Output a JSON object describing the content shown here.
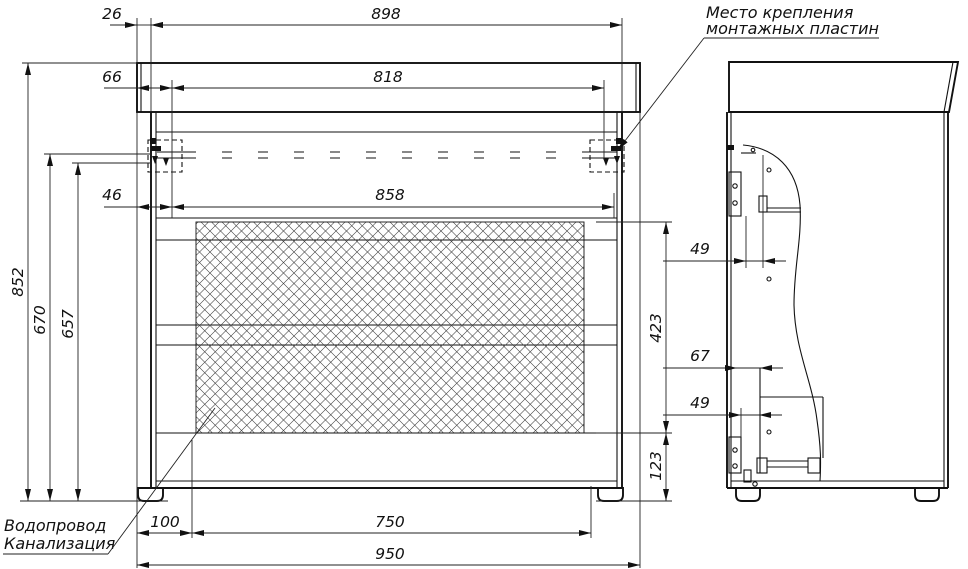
{
  "dims": {
    "d26": "26",
    "d898": "898",
    "d66": "66",
    "d818": "818",
    "d46": "46",
    "d858": "858",
    "d852": "852",
    "d670": "670",
    "d657": "657",
    "d423": "423",
    "d123": "123",
    "d100": "100",
    "d750": "750",
    "d950": "950",
    "d49_top": "49",
    "d67": "67",
    "d49_bottom": "49"
  },
  "annotations": {
    "mounting_line1": "Место крепления",
    "mounting_line2": "монтажных пластин",
    "water": "Водопровод",
    "sewer": "Канализация"
  },
  "colors": {
    "line": "#111111",
    "background": "#ffffff"
  }
}
